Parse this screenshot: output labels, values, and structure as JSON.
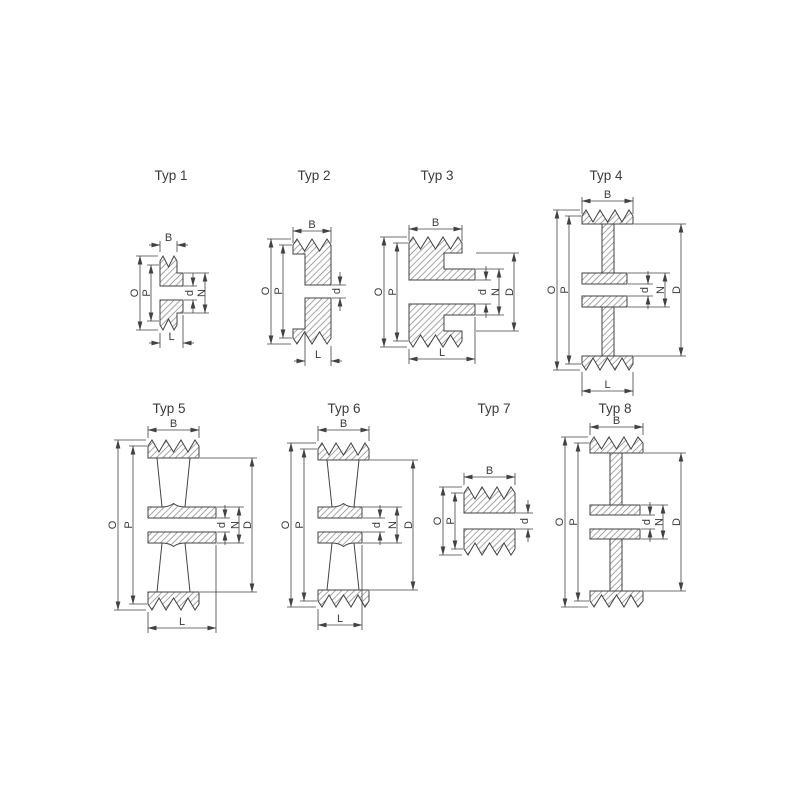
{
  "canvas": {
    "width": 800,
    "height": 800,
    "background": "#ffffff"
  },
  "colors": {
    "line": "#424242",
    "hatch": "#7e7e7e",
    "text": "#3a3a3a"
  },
  "figures": [
    {
      "title": "Typ 1",
      "dims": {
        "B": "B",
        "O": "O",
        "P": "P",
        "d": "d",
        "N": "N",
        "L": "L"
      }
    },
    {
      "title": "Typ 2",
      "dims": {
        "B": "B",
        "O": "O",
        "P": "P",
        "d": "d",
        "L": "L"
      }
    },
    {
      "title": "Typ 3",
      "dims": {
        "B": "B",
        "O": "O",
        "P": "P",
        "d": "d",
        "N": "N",
        "D": "D",
        "L": "L"
      }
    },
    {
      "title": "Typ 4",
      "dims": {
        "B": "B",
        "O": "O",
        "P": "P",
        "d": "d",
        "N": "N",
        "D": "D",
        "L": "L"
      }
    },
    {
      "title": "Typ 5",
      "dims": {
        "B": "B",
        "O": "O",
        "P": "P",
        "d": "d",
        "N": "N",
        "D": "D",
        "L": "L"
      }
    },
    {
      "title": "Typ 6",
      "dims": {
        "B": "B",
        "O": "O",
        "P": "P",
        "d": "d",
        "N": "N",
        "D": "D",
        "L": "L"
      }
    },
    {
      "title": "Typ 7",
      "dims": {
        "B": "B",
        "O": "O",
        "P": "P",
        "d": "d"
      }
    },
    {
      "title": "Typ 8",
      "dims": {
        "B": "B",
        "O": "O",
        "P": "P",
        "d": "d",
        "N": "N",
        "D": "D"
      }
    }
  ]
}
